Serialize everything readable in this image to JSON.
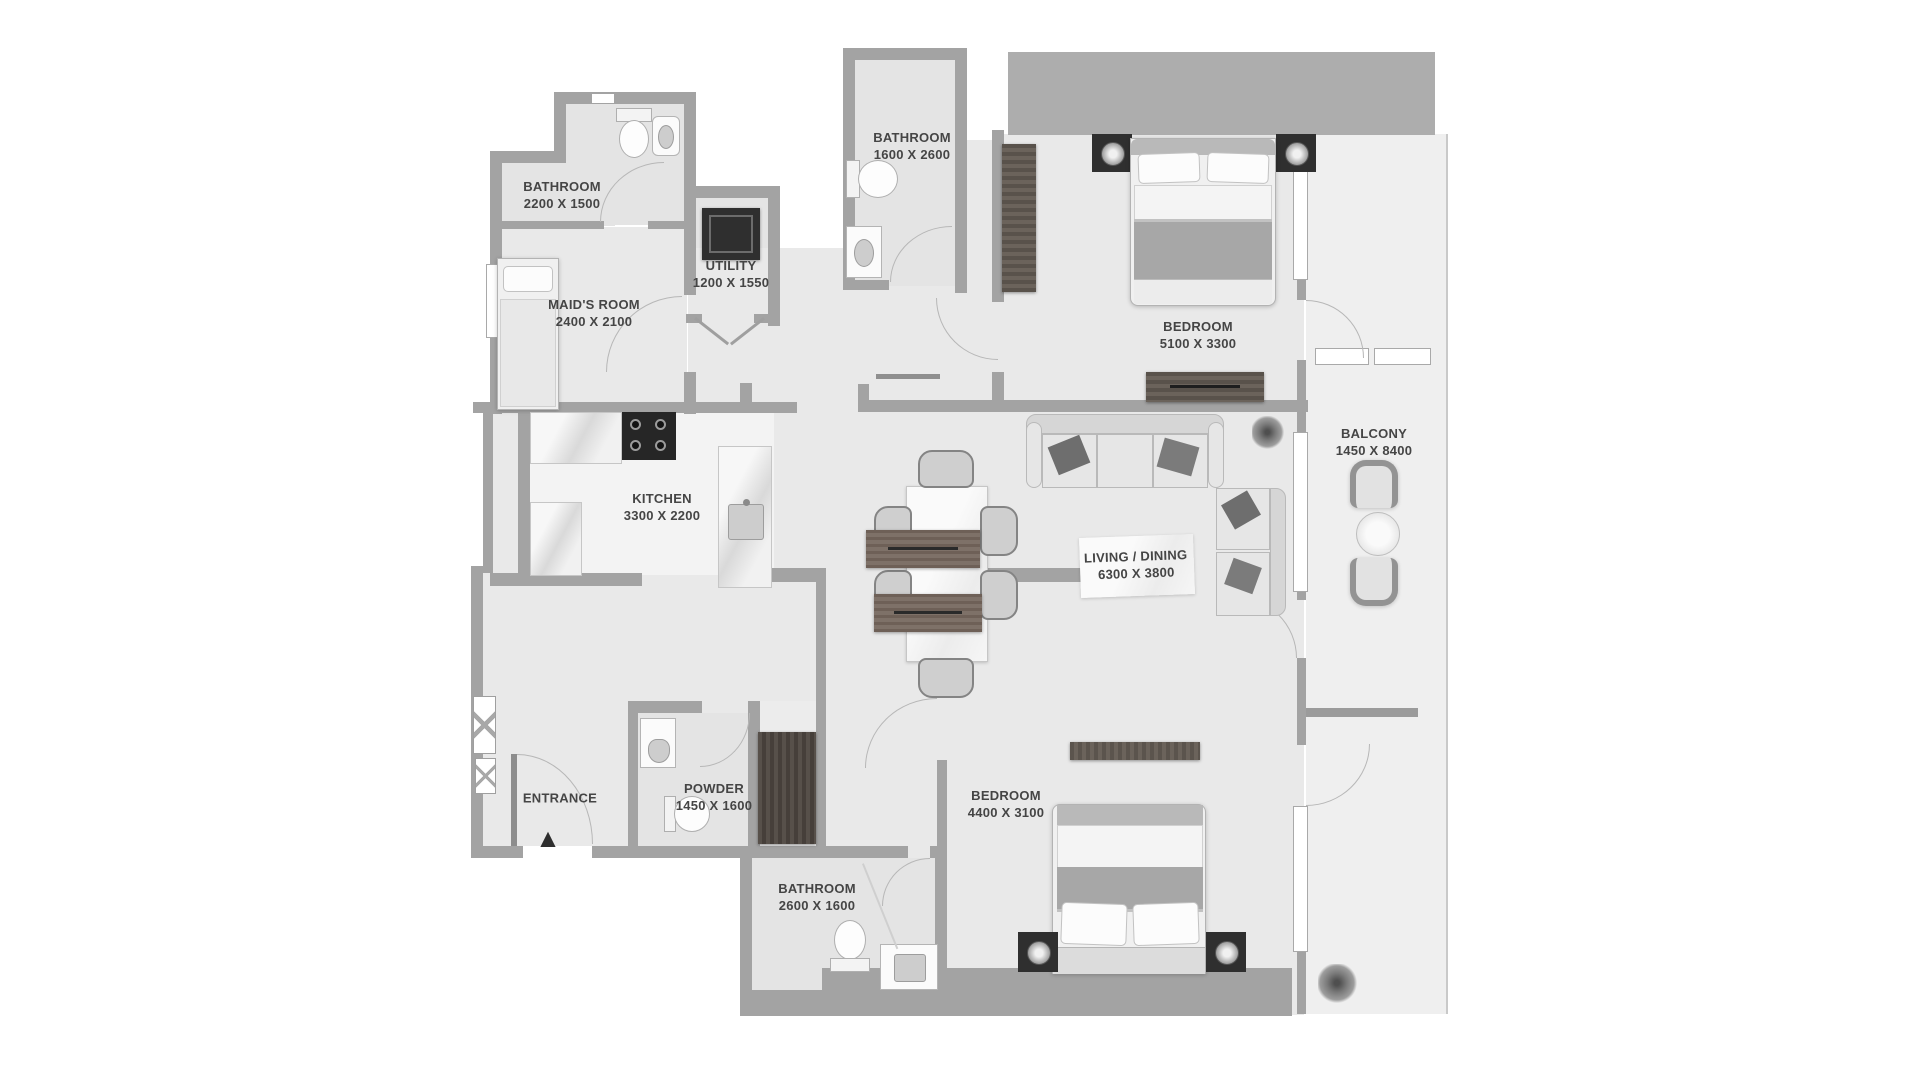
{
  "plan_title": "2 Bedroom + Maid Apartment Floor Plan",
  "colors": {
    "background": "#ffffff",
    "wall": "#a3a3a3",
    "core_block": "#adadad",
    "floor": "#e9e9e9",
    "bath_floor": "#e4e4e4",
    "kitchen_floor": "#f3f3f3",
    "balcony_floor": "#efefef",
    "label_text": "#454545",
    "dark_wood": "#5b544d",
    "appliance_dark": "#2f2f2f"
  },
  "rooms": [
    {
      "name": "BATHROOM",
      "dims": "2200 X 1500"
    },
    {
      "name": "MAID'S ROOM",
      "dims": "2400 X 2100"
    },
    {
      "name": "UTILITY",
      "dims": "1200 X 1550"
    },
    {
      "name": "BATHROOM",
      "dims": "1600 X 2600"
    },
    {
      "name": "BEDROOM",
      "dims": "5100 X 3300"
    },
    {
      "name": "BALCONY",
      "dims": "1450 X 8400"
    },
    {
      "name": "KITCHEN",
      "dims": "3300 X 2200"
    },
    {
      "name": "LIVING / DINING",
      "dims": "6300 X 3800"
    },
    {
      "name": "ENTRANCE",
      "dims": ""
    },
    {
      "name": "POWDER",
      "dims": "1450 X 1600"
    },
    {
      "name": "BEDROOM",
      "dims": "4400 X 3100"
    },
    {
      "name": "BATHROOM",
      "dims": "2600 X 1600"
    }
  ],
  "markers": {
    "entrance_arrow": "▲"
  },
  "furniture_icons": [
    "double-bed",
    "single-bed",
    "wardrobe",
    "dresser",
    "tv-console",
    "sofa",
    "sectional-sofa",
    "dining-table",
    "dining-chair",
    "stove",
    "kitchen-sink",
    "washer",
    "toilet",
    "washbasin",
    "vanity",
    "balcony-chair",
    "balcony-round-table",
    "plant",
    "bench",
    "table-lamp"
  ]
}
